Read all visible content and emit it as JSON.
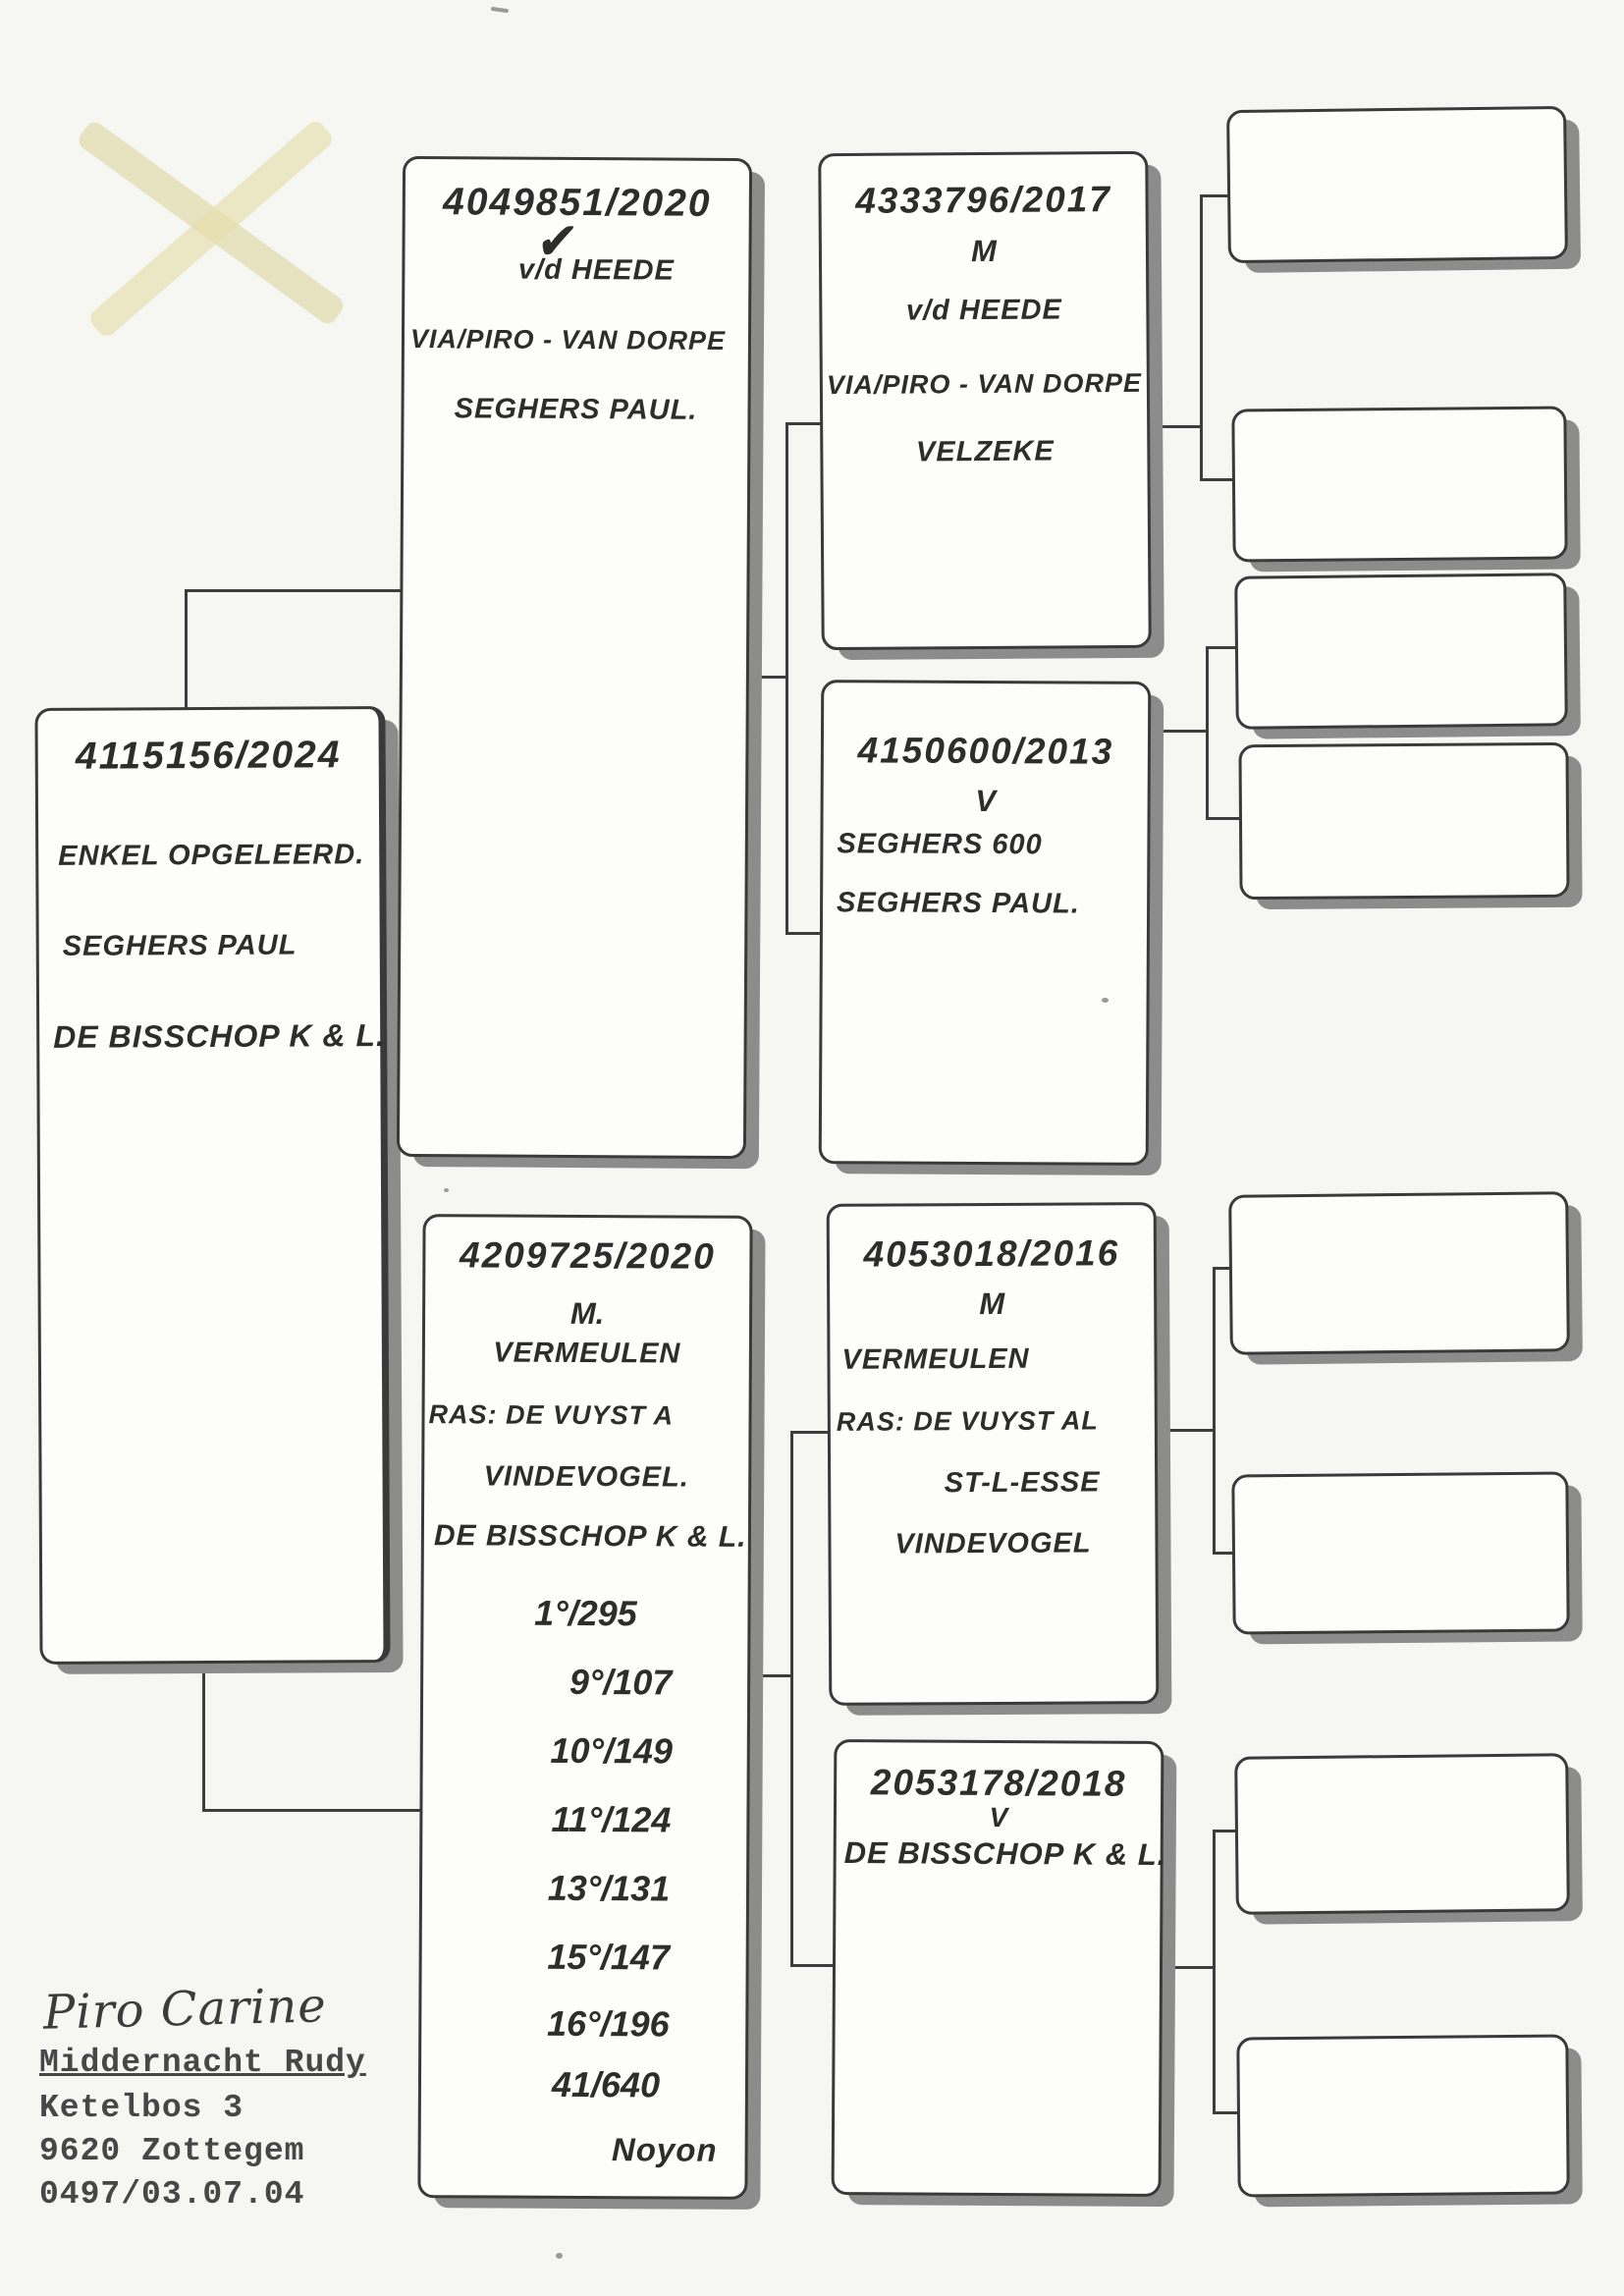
{
  "colors": {
    "ink": "#2d2d2d",
    "box_border": "#3a3a3a",
    "box_shadow": "#8c8c8c",
    "paper": "#f6f6f3",
    "highlight_x": "#ded7a4"
  },
  "pedigree": {
    "subject": {
      "ring": "4115156/2024",
      "lines": [
        "ENKEL OPGELEERD.",
        "SEGHERS PAUL",
        "DE BISSCHOP K & L."
      ]
    },
    "sire": {
      "ring": "4049851/2020",
      "mark": "✔",
      "lines": [
        "v/d HEEDE",
        "VIA/PIRO - VAN DORPE",
        "SEGHERS PAUL."
      ]
    },
    "dam": {
      "ring": "4209725/2020",
      "sex": "M.",
      "lines": [
        "VERMEULEN",
        "RAS: DE VUYST A",
        "VINDEVOGEL.",
        "DE BISSCHOP K & L."
      ],
      "results": [
        "1°/295",
        "9°/107",
        "10°/149",
        "11°/124",
        "13°/131",
        "15°/147",
        "16°/196",
        "41/640"
      ],
      "race_name": "Noyon"
    },
    "grandparents": [
      {
        "ring": "4333796/2017",
        "sex": "M",
        "lines": [
          "v/d HEEDE",
          "VIA/PIRO - VAN DORPE",
          "VELZEKE"
        ]
      },
      {
        "ring": "4150600/2013",
        "sex": "V",
        "lines": [
          "SEGHERS 600",
          "SEGHERS PAUL."
        ]
      },
      {
        "ring": "4053018/2016",
        "sex": "M",
        "lines": [
          "VERMEULEN",
          "RAS: DE VUYST AL",
          "ST-L-ESSE",
          "VINDEVOGEL"
        ]
      },
      {
        "ring": "2053178/2018",
        "sex": "V",
        "lines": [
          "DE BISSCHOP K & L."
        ]
      }
    ],
    "empty_great_grandparent_boxes": 8
  },
  "owner": {
    "signature": "Piro Carine",
    "name": "Middernacht Rudy",
    "street": "Ketelbos 3",
    "city": "9620 Zottegem",
    "phone": "0497/03.07.04"
  }
}
